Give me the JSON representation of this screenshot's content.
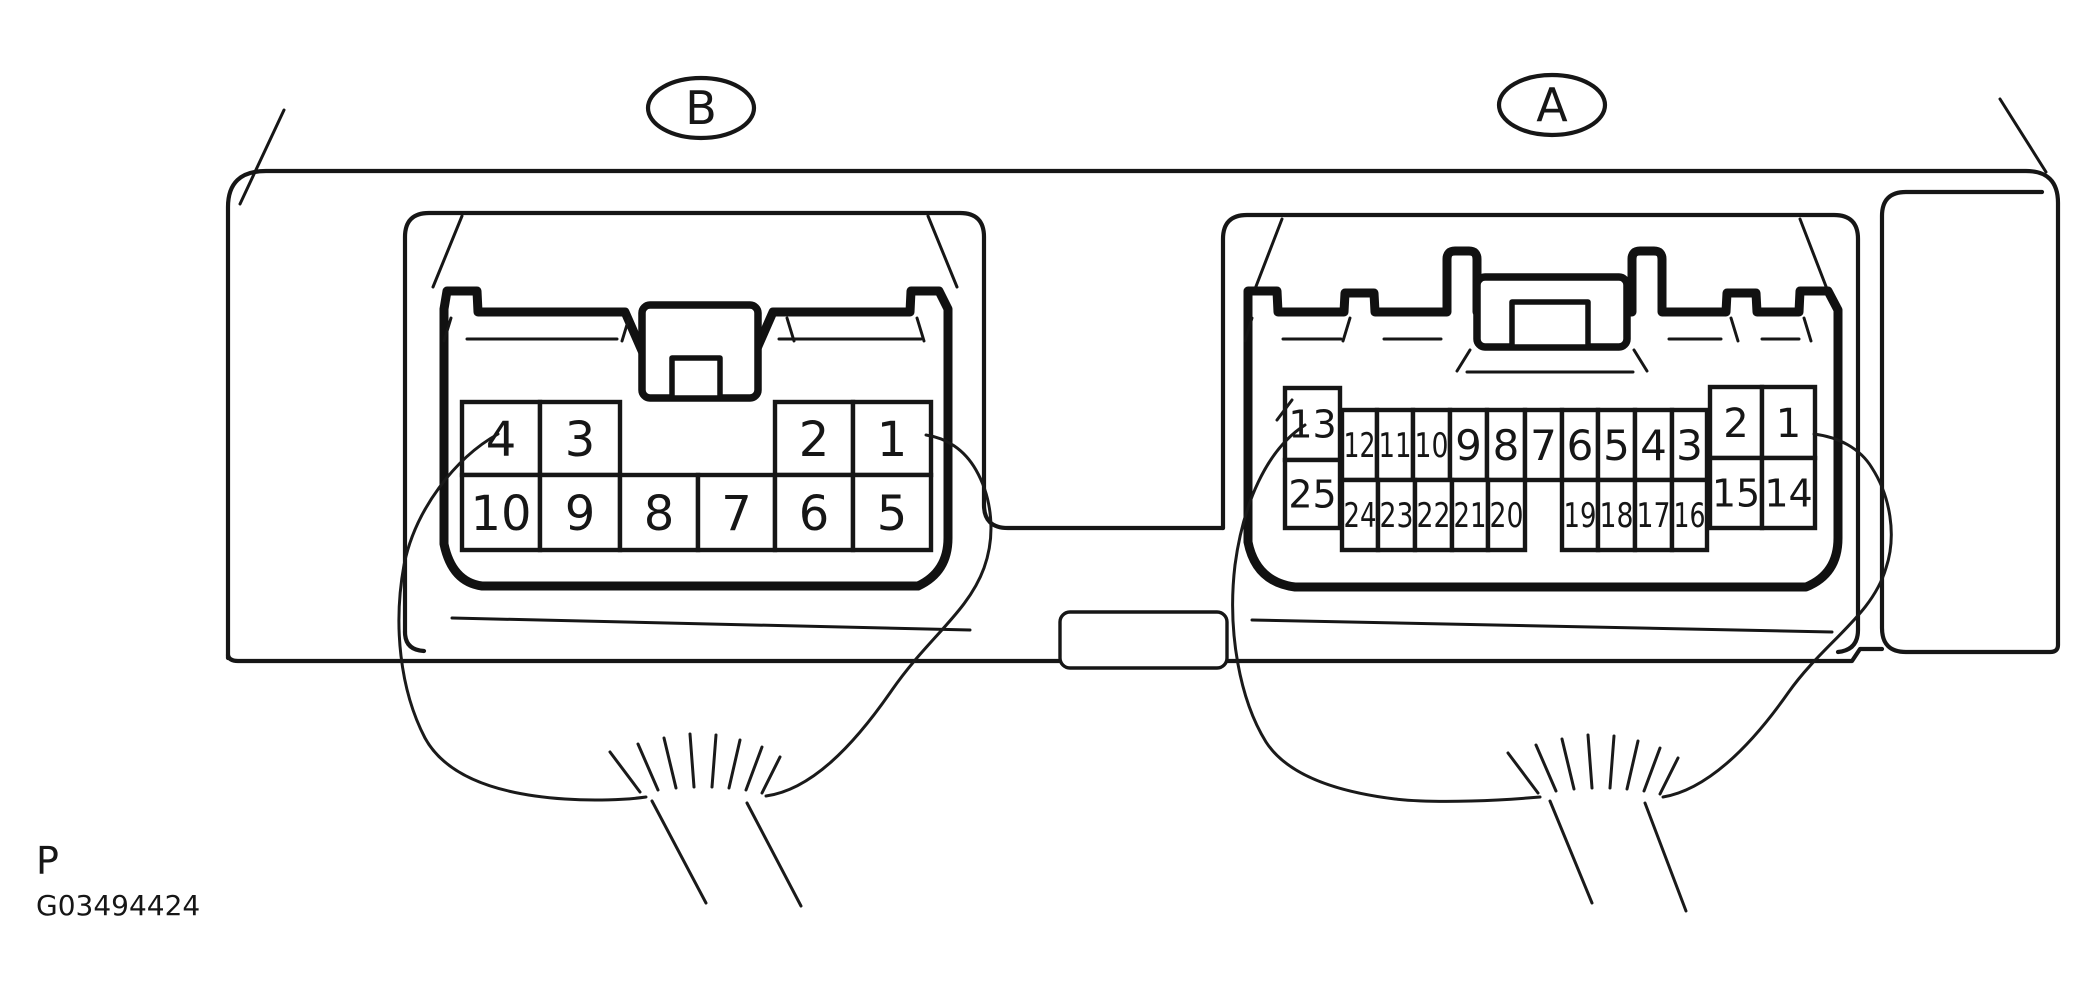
{
  "page": {
    "background": "#ffffff",
    "ink": "#161616"
  },
  "footer": {
    "page_marker": "P",
    "figure_id": "G03494424"
  },
  "connector_b": {
    "label": "B",
    "pins": [
      {
        "n": "4",
        "x": 462,
        "y": 402,
        "w": 78,
        "h": 73,
        "fs": 48
      },
      {
        "n": "3",
        "x": 540,
        "y": 402,
        "w": 80,
        "h": 73,
        "fs": 48
      },
      {
        "n": "2",
        "x": 775,
        "y": 402,
        "w": 78,
        "h": 73,
        "fs": 48
      },
      {
        "n": "1",
        "x": 853,
        "y": 402,
        "w": 78,
        "h": 73,
        "fs": 48
      },
      {
        "n": "10",
        "x": 462,
        "y": 475,
        "w": 78,
        "h": 75,
        "fs": 48
      },
      {
        "n": "9",
        "x": 540,
        "y": 475,
        "w": 80,
        "h": 75,
        "fs": 48
      },
      {
        "n": "8",
        "x": 620,
        "y": 475,
        "w": 78,
        "h": 75,
        "fs": 48
      },
      {
        "n": "7",
        "x": 698,
        "y": 475,
        "w": 77,
        "h": 75,
        "fs": 48
      },
      {
        "n": "6",
        "x": 775,
        "y": 475,
        "w": 78,
        "h": 75,
        "fs": 48
      },
      {
        "n": "5",
        "x": 853,
        "y": 475,
        "w": 78,
        "h": 75,
        "fs": 48
      }
    ]
  },
  "connector_a": {
    "label": "A",
    "pins": [
      {
        "n": "13",
        "x": 1285,
        "y": 388,
        "w": 55,
        "h": 72,
        "fs": 38
      },
      {
        "n": "25",
        "x": 1285,
        "y": 460,
        "w": 55,
        "h": 68,
        "fs": 38
      },
      {
        "n": "12",
        "x": 1342,
        "y": 410,
        "w": 35,
        "h": 70,
        "fs": 34,
        "sq": 1
      },
      {
        "n": "11",
        "x": 1377,
        "y": 410,
        "w": 36,
        "h": 70,
        "fs": 34,
        "sq": 1
      },
      {
        "n": "10",
        "x": 1413,
        "y": 410,
        "w": 37,
        "h": 70,
        "fs": 34,
        "sq": 1
      },
      {
        "n": "9",
        "x": 1450,
        "y": 410,
        "w": 37,
        "h": 70,
        "fs": 42
      },
      {
        "n": "8",
        "x": 1487,
        "y": 410,
        "w": 38,
        "h": 70,
        "fs": 42
      },
      {
        "n": "7",
        "x": 1525,
        "y": 410,
        "w": 37,
        "h": 70,
        "fs": 42
      },
      {
        "n": "6",
        "x": 1562,
        "y": 410,
        "w": 36,
        "h": 70,
        "fs": 42
      },
      {
        "n": "5",
        "x": 1598,
        "y": 410,
        "w": 37,
        "h": 70,
        "fs": 42
      },
      {
        "n": "4",
        "x": 1635,
        "y": 410,
        "w": 37,
        "h": 70,
        "fs": 42
      },
      {
        "n": "3",
        "x": 1672,
        "y": 410,
        "w": 35,
        "h": 70,
        "fs": 42
      },
      {
        "n": "24",
        "x": 1342,
        "y": 480,
        "w": 36,
        "h": 70,
        "fs": 34,
        "sq": 1
      },
      {
        "n": "23",
        "x": 1378,
        "y": 480,
        "w": 37,
        "h": 70,
        "fs": 34,
        "sq": 1
      },
      {
        "n": "22",
        "x": 1415,
        "y": 480,
        "w": 37,
        "h": 70,
        "fs": 34,
        "sq": 1
      },
      {
        "n": "21",
        "x": 1452,
        "y": 480,
        "w": 36,
        "h": 70,
        "fs": 34,
        "sq": 1
      },
      {
        "n": "20",
        "x": 1488,
        "y": 480,
        "w": 37,
        "h": 70,
        "fs": 34,
        "sq": 1
      },
      {
        "n": "19",
        "x": 1562,
        "y": 480,
        "w": 36,
        "h": 70,
        "fs": 34,
        "sq": 1
      },
      {
        "n": "18",
        "x": 1598,
        "y": 480,
        "w": 37,
        "h": 70,
        "fs": 34,
        "sq": 1
      },
      {
        "n": "17",
        "x": 1635,
        "y": 480,
        "w": 37,
        "h": 70,
        "fs": 34,
        "sq": 1
      },
      {
        "n": "16",
        "x": 1672,
        "y": 480,
        "w": 35,
        "h": 70,
        "fs": 34,
        "sq": 1
      },
      {
        "n": "2",
        "x": 1710,
        "y": 387,
        "w": 52,
        "h": 71,
        "fs": 40
      },
      {
        "n": "1",
        "x": 1762,
        "y": 387,
        "w": 53,
        "h": 71,
        "fs": 40
      },
      {
        "n": "15",
        "x": 1710,
        "y": 458,
        "w": 52,
        "h": 70,
        "fs": 38
      },
      {
        "n": "14",
        "x": 1762,
        "y": 458,
        "w": 53,
        "h": 70,
        "fs": 38
      }
    ]
  }
}
